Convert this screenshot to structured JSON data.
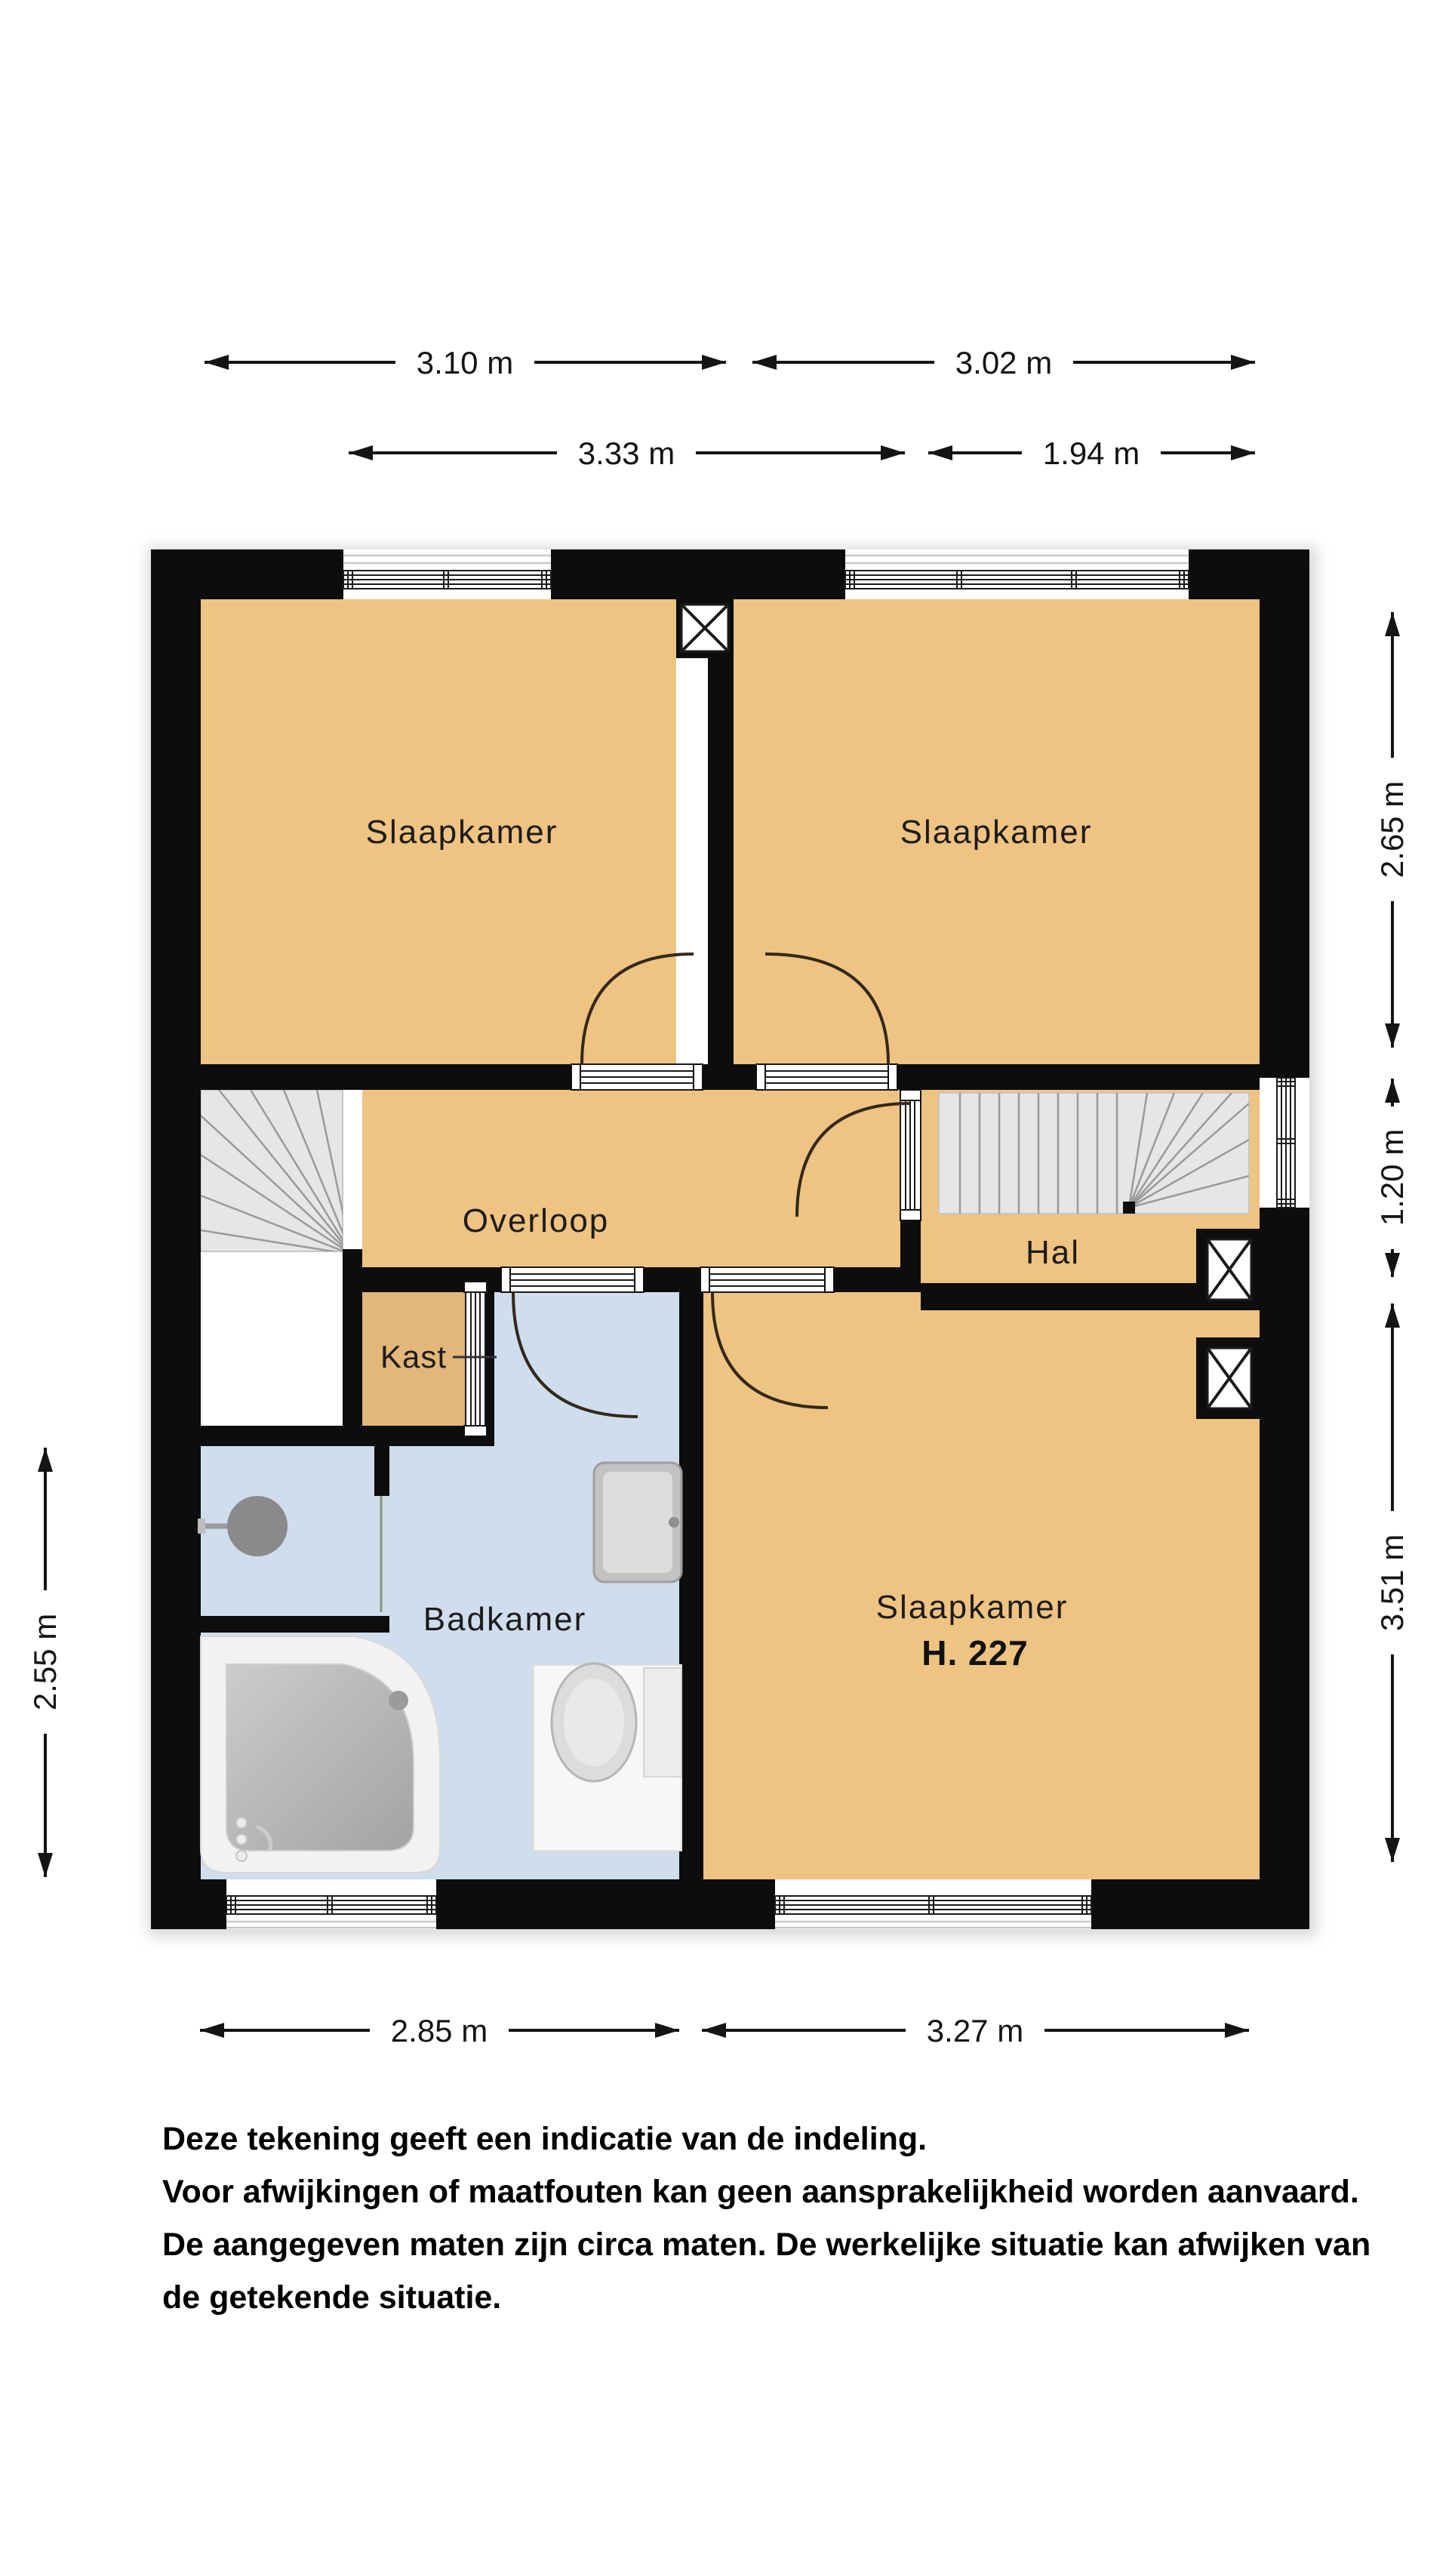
{
  "colors": {
    "wall": "#0d0d0d",
    "room-orange": "#efc381",
    "room-tan": "#e3b679",
    "room-blue": "#cfddec",
    "stair-gray": "#e6e6e6",
    "stair-line": "#9a9a9a",
    "arc": "#33281a",
    "dim": "#141414"
  },
  "rooms": {
    "bedroom_tl": "Slaapkamer",
    "bedroom_tr": "Slaapkamer",
    "overloop": "Overloop",
    "hal": "Hal",
    "kast": "Kast",
    "badkamer": "Badkamer",
    "bedroom_br": "Slaapkamer",
    "bedroom_br_number": "H. 227"
  },
  "dimensions": {
    "top_row1_left": "3.10 m",
    "top_row1_right": "3.02 m",
    "top_row2_left": "3.33 m",
    "top_row2_right": "1.94 m",
    "right_top": "2.65 m",
    "right_middle": "1.20 m",
    "right_bottom": "3.51 m",
    "left_side": "2.55 m",
    "bottom_left": "2.85 m",
    "bottom_right": "3.27 m"
  },
  "disclaimer": {
    "line1": "Deze tekening geeft een indicatie van de indeling.",
    "line2": "Voor afwijkingen of maatfouten kan geen aansprakelijkheid worden aanvaard.",
    "line3": "De aangegeven maten zijn circa maten. De werkelijke situatie kan afwijken van",
    "line4": "de getekende situatie."
  }
}
